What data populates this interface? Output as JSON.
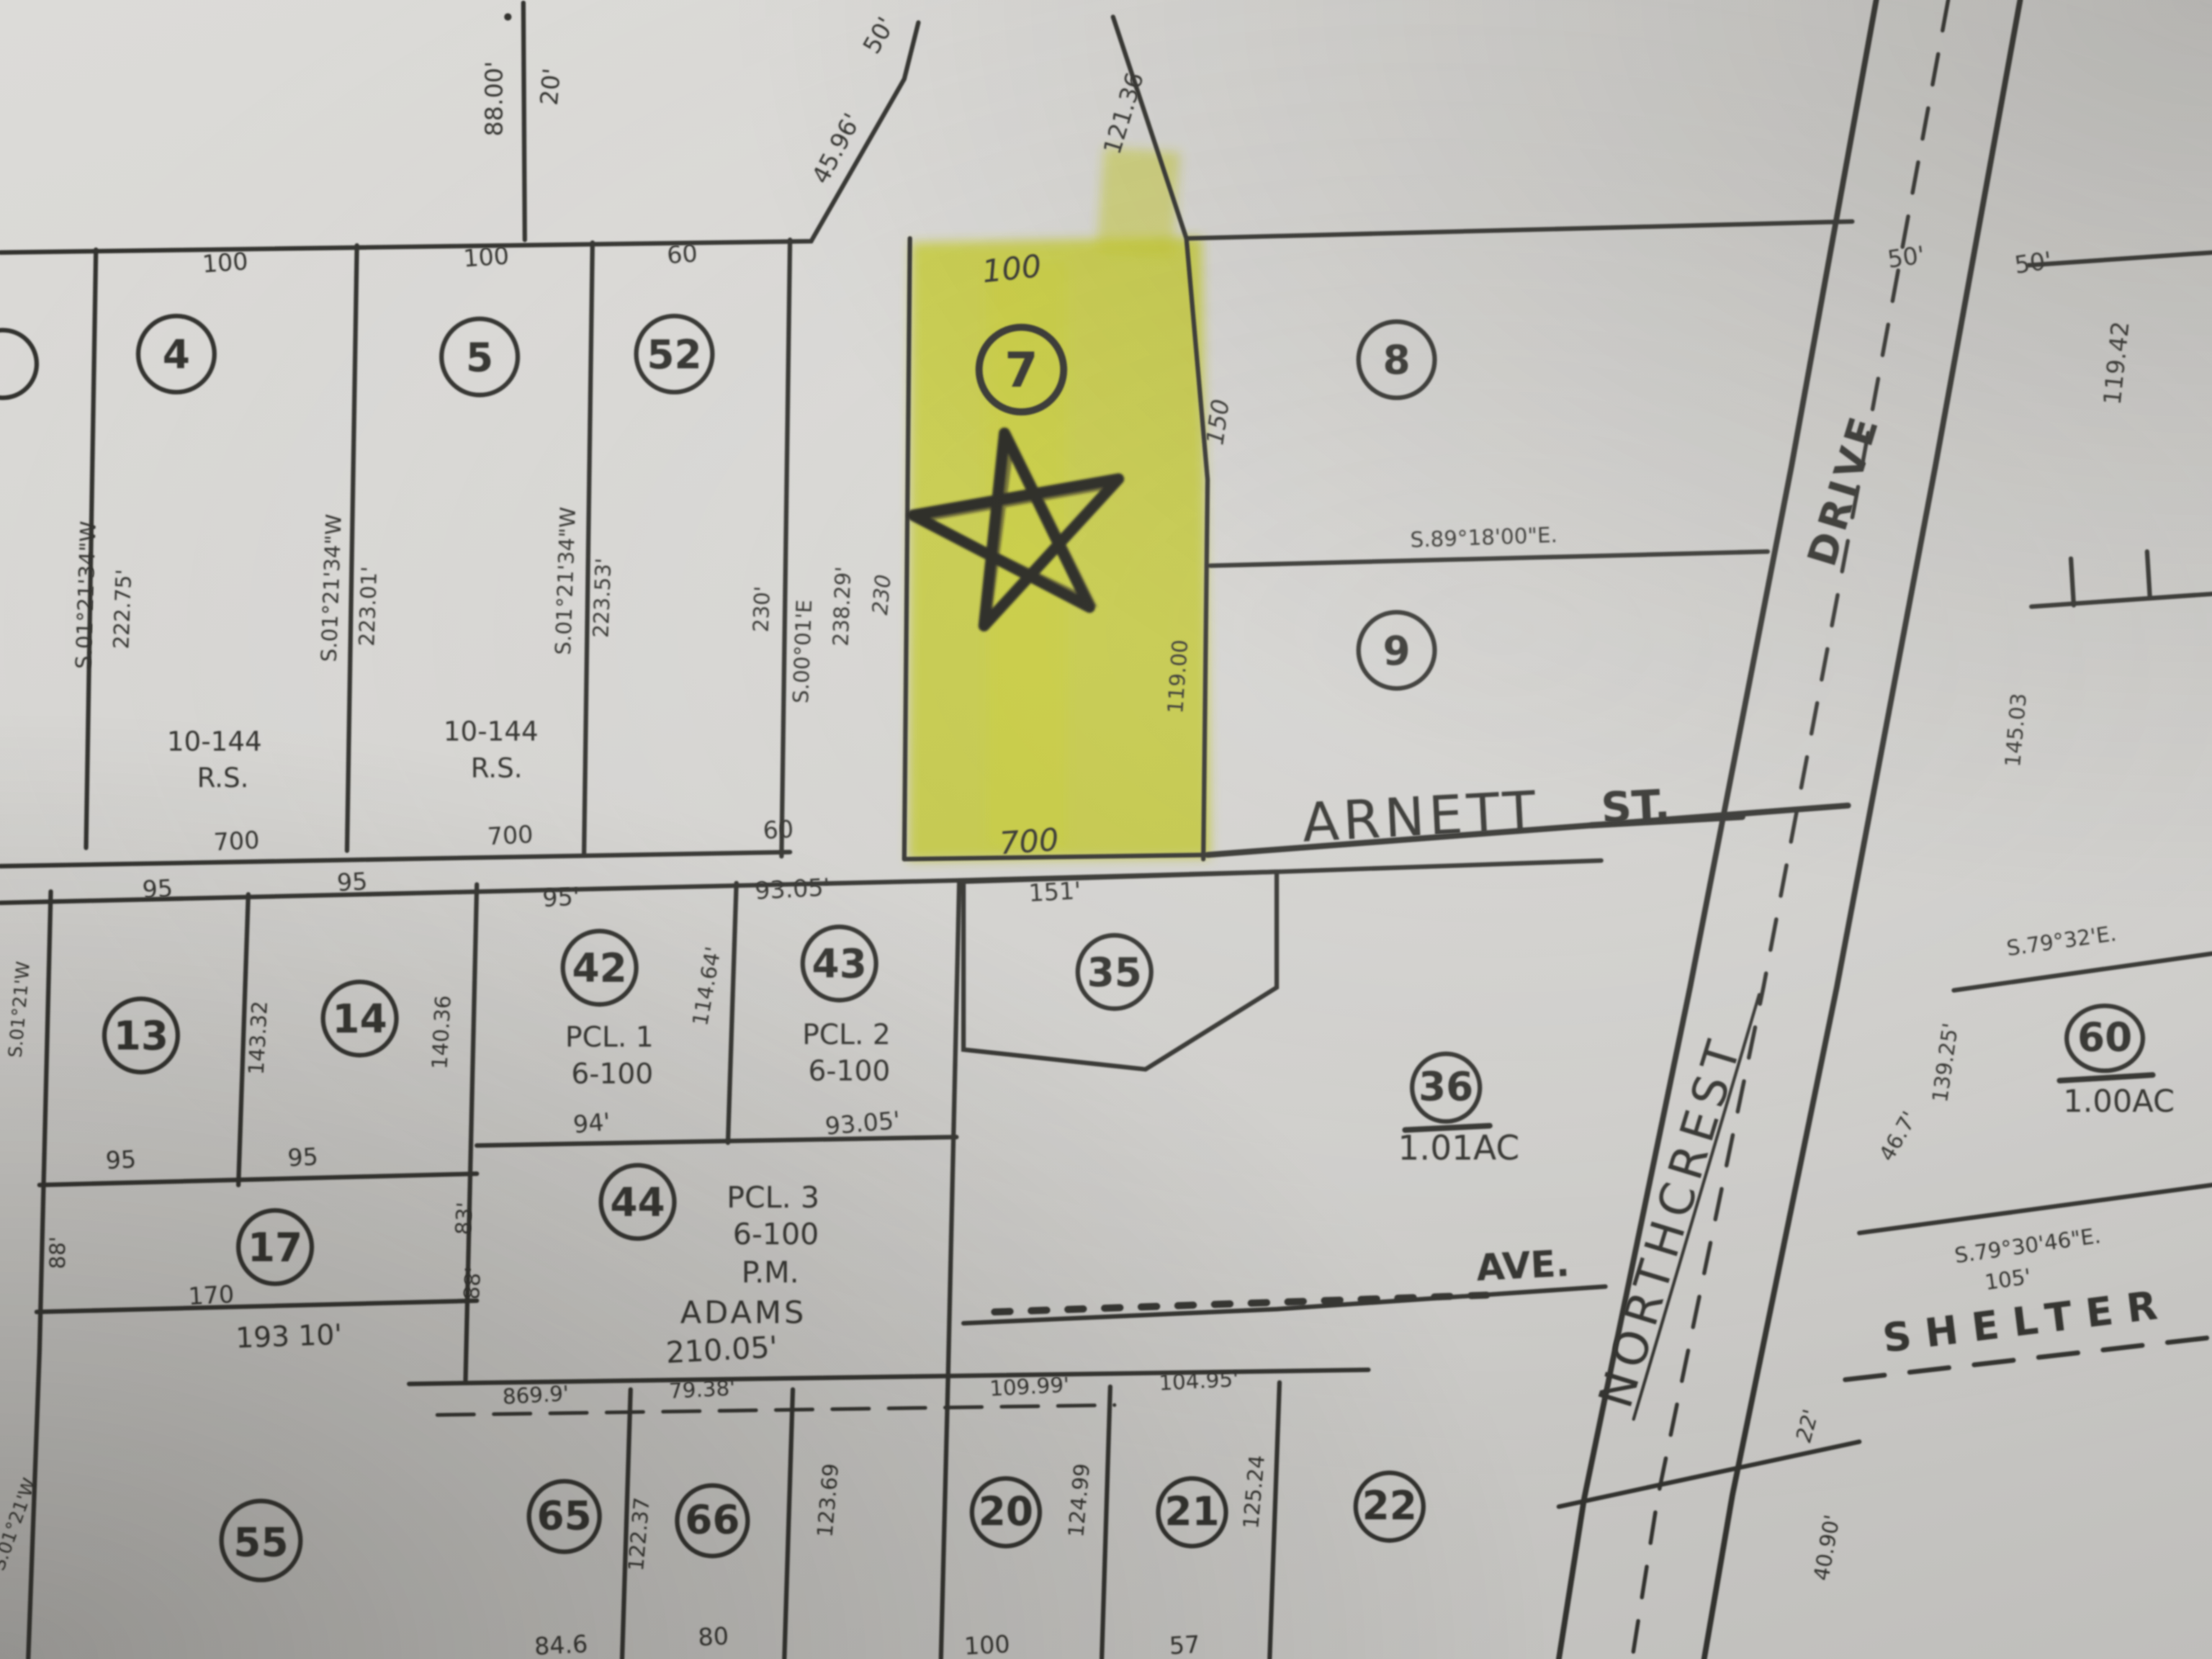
{
  "photo": {
    "description": "Photograph of a photocopied assessor plat map with parcel 7 marked in yellow highlighter and a hand-drawn star",
    "paper_color": "#d8d7d4",
    "ink_color": "#32312d",
    "highlight_color": "#e7ee2c"
  },
  "streets": {
    "arnett": "ARNETT",
    "arnett_type": "ST.",
    "northcrest": "NORTHCREST",
    "northcrest_type": "DRIVE",
    "shelter": "SHELTER",
    "ave": "AVE."
  },
  "lots": {
    "lot4": "4",
    "lot5": "5",
    "lot52": "52",
    "lot7": "7",
    "lot8": "8",
    "lot9": "9",
    "lot13": "13",
    "lot14": "14",
    "lot42": "42",
    "lot43": "43",
    "lot35": "35",
    "lot36": "36",
    "lot17": "17",
    "lot44": "44",
    "lot60": "60",
    "lot55": "55",
    "lot65": "65",
    "lot66": "66",
    "lot20": "20",
    "lot21": "21",
    "lot22": "22"
  },
  "parcels": {
    "pcl1": "PCL. 1",
    "pcl1_map": "6-100",
    "pcl2": "PCL. 2",
    "pcl2_map": "6-100",
    "pcl3": "PCL. 3",
    "pcl3_map": "6-100",
    "pcl3_pm": "P.M.",
    "pcl3_name": "ADAMS",
    "rs1_num": "10-144",
    "rs1_type": "R.S.",
    "rs2_num": "10-144",
    "rs2_type": "R.S.",
    "acre36": "1.01AC",
    "acre60": "1.00AC"
  },
  "dims": {
    "d01": "88.00'",
    "d02": "20'",
    "d03": "45.96'",
    "d04": "50'",
    "d05": "121.36",
    "d06": "50'",
    "d07": "50'",
    "d08": "119.42",
    "d09": "100",
    "d10": "100",
    "d11": "60",
    "d12": "S.01°21'34\"W",
    "d13": "222.75'",
    "d14": "S.01°21'34\"W",
    "d15": "223.01'",
    "d16": "S.01°21'34\"W",
    "d17": "223.53'",
    "d18": "230'",
    "d19": "S.00°01'E",
    "d20": "238.29'",
    "d21": "230",
    "d22": "100",
    "d23": "150",
    "d24": "119.00",
    "d25": "S.89°18'00\"E.",
    "d26": "700",
    "d31": "700",
    "d32": "700",
    "d33": "60",
    "d34": "95",
    "d35": "95",
    "d36": "143.32",
    "d37": "140.36",
    "d38": "95",
    "d39": "95",
    "d40": "95'",
    "d41": "93.05'",
    "d42": "114.64'",
    "d43": "94'",
    "d44": "93.05'",
    "d45": "151'",
    "d46": "88'",
    "d47": "83'",
    "d48": "88'",
    "d49": "170",
    "d50": "193 10'",
    "d51": "210.05'",
    "d52": "869.9'",
    "d53": "79.38'",
    "d54": "109.99'",
    "d55": "104.95'",
    "d56": "122.37",
    "d57": "123.69",
    "d58": "124.99",
    "d59": "125.24",
    "d60": "84.6",
    "d61": "80",
    "d62": "100",
    "d63": "57",
    "d64": "145.03",
    "d65": "139.25'",
    "d66": "46.7'",
    "d67": "S.79°32'E.",
    "d68": "S.79°30'46\"E.",
    "d69": "105'",
    "d70": "22'",
    "d71": "40.90'",
    "d72": "S.01°21'W",
    "d73": "S.01°21'W"
  }
}
